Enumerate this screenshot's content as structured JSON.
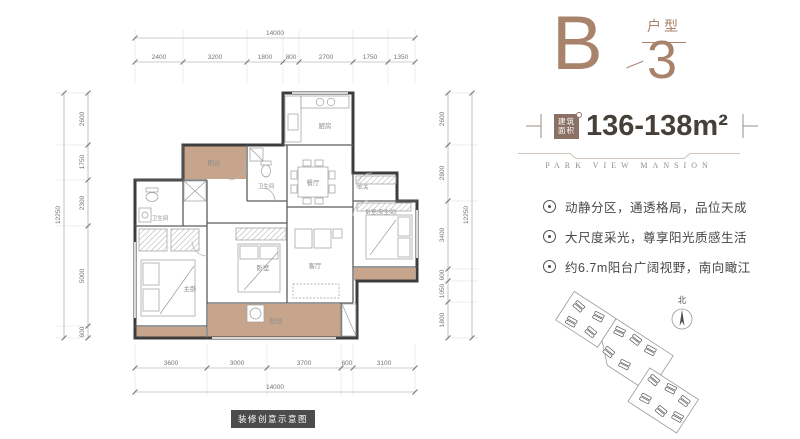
{
  "header": {
    "letter": "B",
    "type_label": "户型",
    "number": "3"
  },
  "area": {
    "badge_top": "建筑",
    "badge_bottom": "面积",
    "value": "136-138m²"
  },
  "brand": "PARK VIEW MANSION",
  "features": [
    {
      "text": "动静分区，通透格局，品位天成"
    },
    {
      "text": "大尺度采光，尊享阳光质感生活"
    },
    {
      "text": "约6.7m阳台广阔视野，南向瞰江"
    }
  ],
  "compass_label": "北",
  "caption": "装修创意示意图",
  "floorplan": {
    "rooms": [
      {
        "label": "阳台"
      },
      {
        "label": "卫生间"
      },
      {
        "label": "厨房"
      },
      {
        "label": "餐厅"
      },
      {
        "label": "玄关"
      },
      {
        "label": "卧室(安全间)"
      },
      {
        "label": "客厅"
      },
      {
        "label": "卧室"
      },
      {
        "label": "主卧"
      },
      {
        "label": "卫生间"
      },
      {
        "label": "阳台"
      }
    ],
    "dimensions": {
      "top": {
        "total": "14000",
        "segments": [
          "2400",
          "3200",
          "1800",
          "800",
          "2700",
          "1750",
          "1350"
        ]
      },
      "bottom": {
        "total": "14000",
        "segments": [
          "3600",
          "3000",
          "3700",
          "600",
          "3100"
        ]
      },
      "left": {
        "total": "12250",
        "segments": [
          "2600",
          "1750",
          "2300",
          "5000",
          "600"
        ]
      },
      "right": {
        "total": "12250",
        "segments": [
          "2600",
          "2800",
          "3400",
          "600",
          "1050",
          "1800"
        ]
      }
    }
  },
  "colors": {
    "accent": "#a8826a",
    "badge": "#8b7164",
    "balcony_fill": "#c7a58d",
    "wall": "#3d3d3d",
    "text_dark": "#46403a"
  }
}
